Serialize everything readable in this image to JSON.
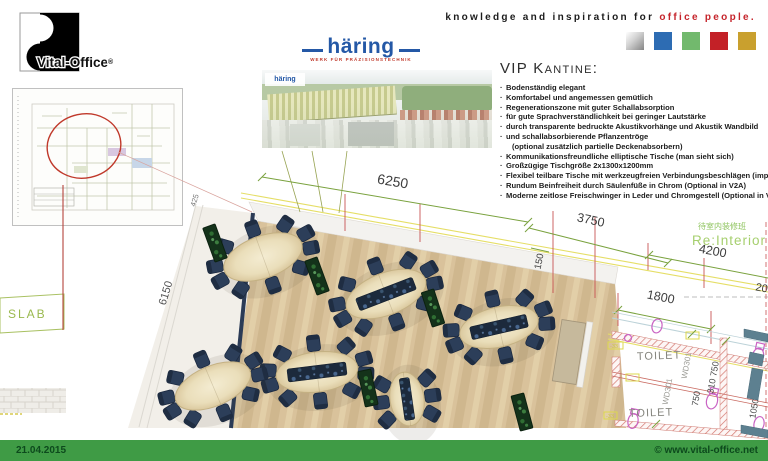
{
  "header": {
    "brand": "Vital-Office",
    "brand_reg": "®",
    "tagline_prefix": "knowledge and inspiration for ",
    "tagline_highlight": "office people.",
    "palette": [
      "#silver-gradient",
      "#2d6cb3",
      "#72b96d",
      "#c32127",
      "#c9a02e"
    ]
  },
  "haering": {
    "name": "häring",
    "tagline": "WERK FÜR PRÄZISIONSTECHNIK"
  },
  "vip": {
    "title": "VIP Kantine:",
    "bullets": [
      {
        "bullet": true,
        "text": "Bodenständig elegant"
      },
      {
        "bullet": true,
        "text": "Komfortabel und angemessen gemütlich"
      },
      {
        "bullet": true,
        "text": "Regenerationszone mit guter Schallabsorption"
      },
      {
        "bullet": true,
        "text": "für gute Sprachverständlichkeit bei geringer Lautstärke"
      },
      {
        "bullet": true,
        "text": "durch transparente bedruckte Akustikvorhänge und Akustik Wandbild"
      },
      {
        "bullet": true,
        "text": "und schallabsorbierende Pflanzentröge"
      },
      {
        "bullet": false,
        "text": "(optional zusätzlich partielle Deckenabsorbern)"
      },
      {
        "bullet": true,
        "text": "Kommunikationsfreundliche elliptische Tische (man sieht sich)"
      },
      {
        "bullet": true,
        "text": "Großzügige Tischgröße 2x1300x1200mm"
      },
      {
        "bullet": true,
        "text": "Flexibel teilbare Tische mit werkzeugfreien Verbindungsbeschlägen (importiert)"
      },
      {
        "bullet": true,
        "text": "Rundum Beinfreiheit durch Säulenfüße in Chrom (Optional in V2A)"
      },
      {
        "bullet": true,
        "text": "Moderne zeitlose Freischwinger in Leder und Chromgestell (Optional in V2A)"
      }
    ]
  },
  "floorplan": {
    "dims": {
      "top": "6250",
      "window": "3750",
      "wall": "150",
      "door": "1800",
      "room": "4200",
      "edge": "200",
      "left": "6150",
      "small": "425"
    },
    "labels": {
      "slab": "SLAB",
      "re_interior": "Re:Interior",
      "re_interior_zh": "待室内装修班"
    },
    "toilet": {
      "room1": "TOILET",
      "room2": "TOILET",
      "door1": "WD301",
      "door2": "WD301",
      "d1": "750",
      "d2": "310 750",
      "d3": "1050",
      "tag1": "-33",
      "tag2": "-33"
    },
    "tables": [
      {
        "x": 263,
        "y": 257,
        "rx": 41,
        "ry": 21,
        "rot": -20,
        "runner": "none",
        "chairs": [
          15,
          50,
          90,
          130,
          165,
          195,
          230,
          270,
          310,
          345
        ]
      },
      {
        "x": 386,
        "y": 294,
        "rx": 42,
        "ry": 21,
        "rot": -21,
        "runner": "h",
        "chairs": [
          15,
          50,
          90,
          130,
          165,
          195,
          230,
          270,
          310,
          345
        ]
      },
      {
        "x": 499,
        "y": 327,
        "rx": 40,
        "ry": 20,
        "rot": -13,
        "runner": "h",
        "chairs": [
          15,
          50,
          90,
          130,
          165,
          195,
          230,
          270,
          310,
          345
        ]
      },
      {
        "x": 317,
        "y": 372,
        "rx": 41,
        "ry": 20,
        "rot": -7,
        "runner": "h",
        "chairs": [
          15,
          50,
          90,
          130,
          165,
          195,
          230,
          270,
          310,
          345
        ]
      },
      {
        "x": 213,
        "y": 386,
        "rx": 40,
        "ry": 20,
        "rot": -23,
        "runner": "none",
        "chairs": [
          15,
          50,
          90,
          130,
          165,
          195,
          230,
          270,
          310,
          345
        ]
      },
      {
        "x": 407,
        "y": 399,
        "rx": 17,
        "ry": 27,
        "rot": -8,
        "runner": "v",
        "chairs": [
          150,
          180,
          210,
          330,
          0,
          30
        ]
      }
    ],
    "planters": [
      {
        "x": 215,
        "y": 243,
        "rot": -20
      },
      {
        "x": 317,
        "y": 276,
        "rot": -20
      },
      {
        "x": 433,
        "y": 308,
        "rot": -18
      },
      {
        "x": 368,
        "y": 388,
        "rot": -12
      },
      {
        "x": 522,
        "y": 412,
        "rot": -15
      }
    ],
    "sideboard": {
      "x": 569,
      "y": 352,
      "rot": 9
    }
  },
  "footer": {
    "date": "21.04.2015",
    "website": "© www.vital-office.net",
    "bar_color": "#3f9b45"
  }
}
